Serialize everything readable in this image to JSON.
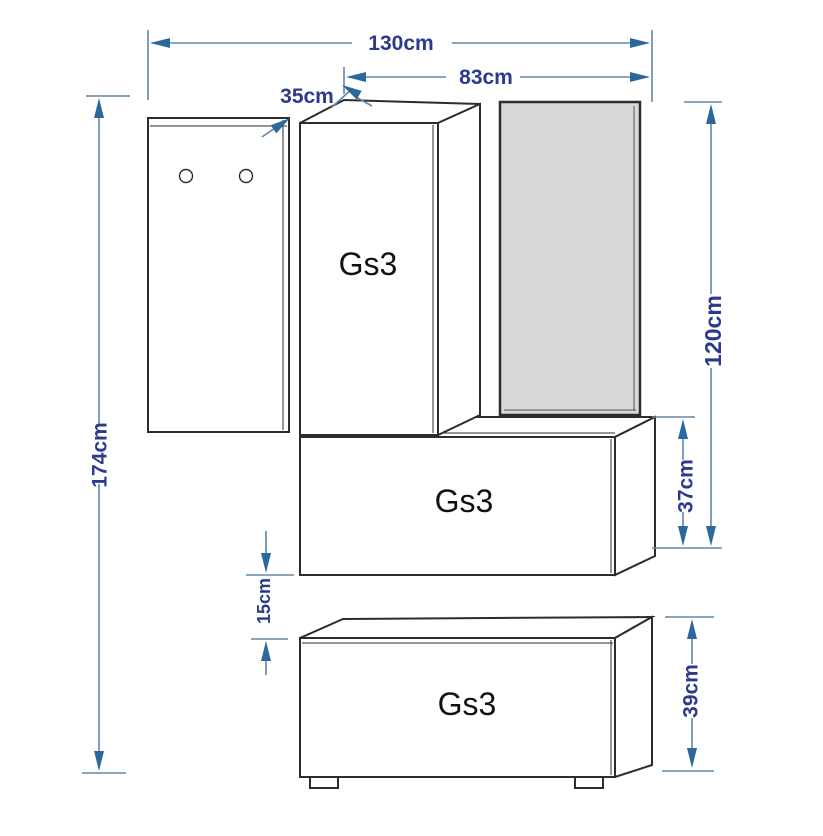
{
  "units": "cm",
  "colors": {
    "background": "#ffffff",
    "outline": "#2d2d2d",
    "mirror_fill": "#d8d8d8",
    "dim_line": "#5d87ab",
    "dim_arrow": "#2c689c",
    "dim_label": "#2b3a8c",
    "unit_label": "#111111"
  },
  "furniture": {
    "hanger_panel": {
      "hooks": 2
    },
    "wall_cabinet": {
      "label": "Gs3"
    },
    "middle_cabinet": {
      "label": "Gs3"
    },
    "bottom_cabinet": {
      "label": "Gs3"
    }
  },
  "dimensions": {
    "total_width": "130cm",
    "upper_width": "83cm",
    "depth": "35cm",
    "total_height": "174cm",
    "upper_height": "120cm",
    "middle_cabinet_height": "37cm",
    "gap": "15cm",
    "bottom_cabinet_height": "39cm"
  }
}
